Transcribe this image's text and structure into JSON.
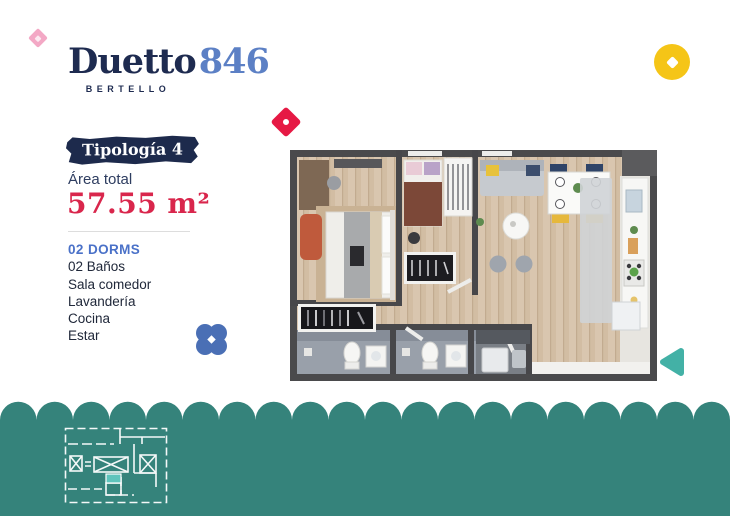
{
  "logo": {
    "title": "Duetto",
    "number": "846",
    "subtitle": "BERTELLO",
    "title_color": "#1E2B50",
    "number_color": "#5C80C5"
  },
  "typology": {
    "badge_label": "Tipología 4",
    "badge_bg": "#1D2A4C",
    "area_label": "Área total",
    "area_value": "57.55 m²",
    "area_value_color": "#D9264C"
  },
  "features": {
    "dorms": "02 DORMS",
    "dorms_color": "#4A71C8",
    "items": [
      "02 Baños",
      "Sala comedor",
      "Lavandería",
      "Cocina",
      "Estar"
    ]
  },
  "decor": {
    "pink_diamond": "#F3A8C5",
    "red_diamond": "#E61944",
    "yellow_circle": "#F5C517",
    "blue_clover": "#4A6FB5",
    "teal_arrow": "#43B1A6",
    "wave": "#35837B",
    "miniplan_unit_highlight": "#5EC4BC"
  },
  "floorplan": {
    "wall_color": "#4A4A4C",
    "wood_color": "#D9C6AF",
    "bath_floor_color": "#99A0AA",
    "kitchen_floor_color": "#E7E5E0"
  }
}
